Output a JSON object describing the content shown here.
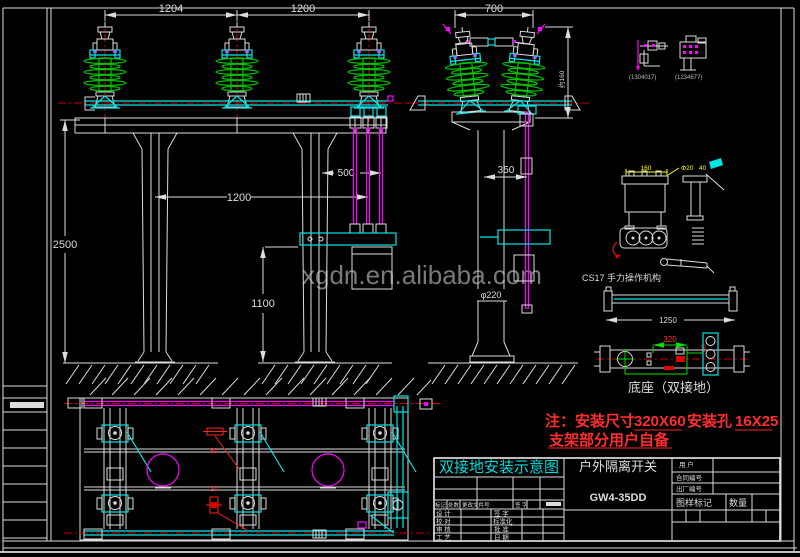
{
  "colors": {
    "background": "#000000",
    "line_white": "#dcdcdc",
    "cyan": "#00e5e5",
    "magenta": "#ff00ff",
    "insulator_green": "#00c000",
    "dim_green": "#00e000",
    "note_red": "#ff2d2d",
    "centerline_red": "#cf0000",
    "yellow": "#ffff00",
    "title_cyan": "#00dcdc",
    "watermark_gray": "#8f8f8f"
  },
  "watermark": "xgdn.en.alibaba.com",
  "note": {
    "prefix": "注：安装尺寸",
    "dim1": "320X60",
    "mid": "安装孔",
    "dim2": "16X25",
    "line2": "支架部分用户自备"
  },
  "labels": {
    "mechanism": "CS17 手力操作机构",
    "base": "底座（双接地）",
    "detail_a": "(1304017)",
    "detail_b": "(1234677)"
  },
  "dims": {
    "front_span1": "1204",
    "front_span2": "1200",
    "front_height": "2500",
    "front_pillar_span": "1200",
    "front_rod_height": "1100",
    "front_offset": "500",
    "side_span": "700",
    "side_offset": "350",
    "side_height_note": "约160",
    "side_pole_dia": "φ220",
    "mech_width": "160",
    "mech_hole": "Φ20",
    "mech_depth": "40",
    "bar_length": "1250",
    "base_hole_span": "320",
    "base_hole_offset": "60",
    "plan_callout_top": "80",
    "plan_callout_bottom": "20"
  },
  "titleblock": {
    "title": "双接地安装示意图",
    "product": "户外隔离开关",
    "model": "GW4-35DD",
    "customer": "用  户",
    "contract_no": "合同编号",
    "factory_no": "出厂编号",
    "drawing_mark": "图样标记",
    "quantity": "数量",
    "rev_mark": "标记",
    "rev_count": "处数",
    "rev_doc": "更改文件号",
    "rev_sign": "签 字",
    "design": "设 计",
    "sign": "签 字",
    "check": "校 对",
    "standard": "标准化",
    "review": "审 核",
    "approve": "批 准",
    "process": "工 艺",
    "date": "日 期"
  }
}
